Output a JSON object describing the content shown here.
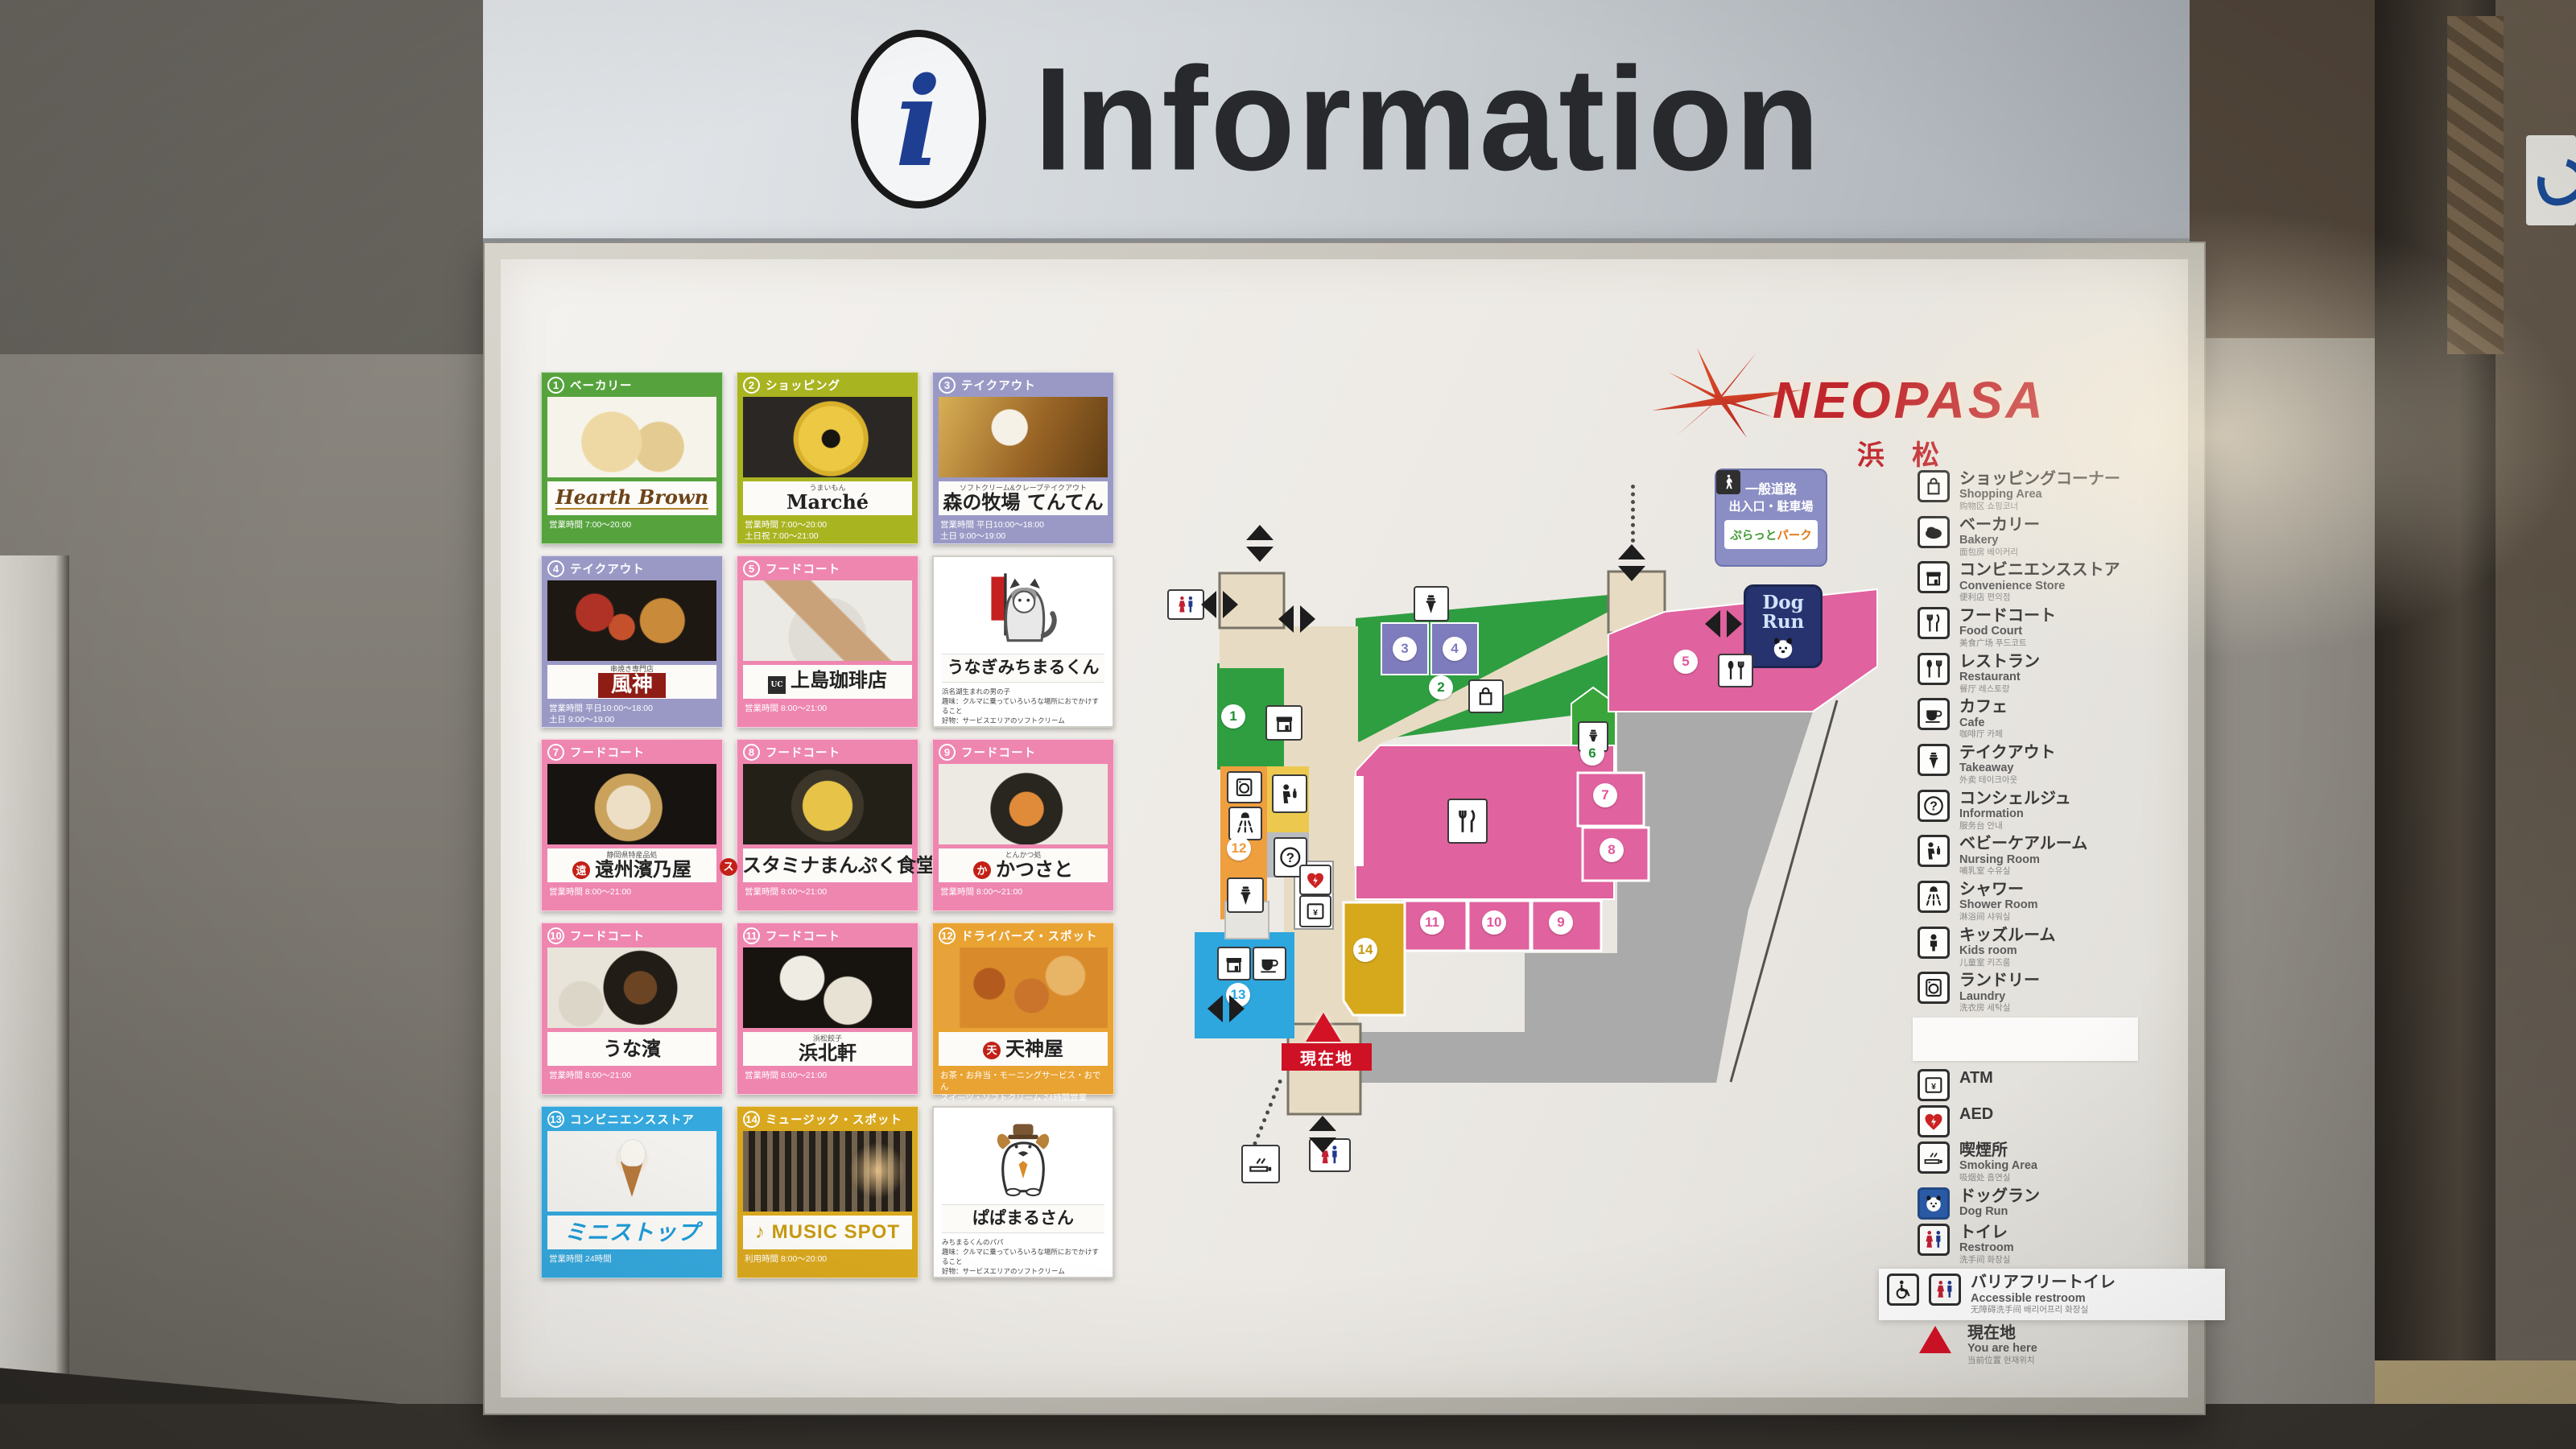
{
  "header": {
    "title": "Information",
    "icon": "info-i"
  },
  "brand": {
    "name": "NEOPASA",
    "location": "浜松"
  },
  "accent_colors": {
    "green": "#56a33e",
    "lime": "#a9b421",
    "lavender": "#9a99c6",
    "pink": "#ee86b0",
    "amber": "#e9a333",
    "blue": "#35a8dd",
    "gold": "#d9a81f",
    "map_pink": "#e0629e",
    "map_green": "#2f9e41",
    "map_beige": "#e7dcc3",
    "current_red": "#cf1126"
  },
  "cards": [
    {
      "num": "1",
      "category": "ベーカリー",
      "name": "Hearth Brown",
      "name_sub": "",
      "foot": [
        "営業時間 7:00～20:00"
      ],
      "theme": "green",
      "photo": "bread",
      "name_style": "script"
    },
    {
      "num": "2",
      "category": "ショッピング",
      "name": "Marché",
      "name_sub": "うまいもん",
      "foot": [
        "営業時間 7:00～20:00",
        "土日祝 7:00～21:00"
      ],
      "theme": "lime",
      "photo": "baum",
      "name_style": "serif"
    },
    {
      "num": "3",
      "category": "テイクアウト",
      "name": "森の牧場 てんてん",
      "name_sub": "ソフトクリーム&クレープテイクアウト",
      "foot": [
        "営業時間 平日10:00～18:00",
        "土日 9:00～19:00"
      ],
      "theme": "lav",
      "photo": "soft",
      "name_style": "plain"
    },
    {
      "num": "4",
      "category": "テイクアウト",
      "name": "風神",
      "name_sub": "串焼き専門店",
      "foot": [
        "営業時間 平日10:00～18:00",
        "土日 9:00～19:00"
      ],
      "theme": "lav",
      "photo": "skewer",
      "name_style": "banner"
    },
    {
      "num": "5",
      "category": "フードコート",
      "name": "上島珈琲店",
      "name_sub": "",
      "foot": [
        "営業時間 8:00～21:00"
      ],
      "theme": "pink",
      "photo": "sand",
      "name_style": "sqlogo"
    },
    {
      "mascot": true,
      "name": "うなぎみちまるくん",
      "profile": [
        "浜名湖生まれの男の子",
        "趣味：クルマに乗っていろいろな場所におでかけすること",
        "好物：サービスエリアのソフトクリーム"
      ],
      "photo": "mascot-unagi"
    },
    {
      "num": "7",
      "category": "フードコート",
      "name": "遠州濱乃屋",
      "name_sub": "静岡県特産品処",
      "foot": [
        "営業時間 8:00～21:00"
      ],
      "theme": "pink",
      "photo": "bowl7",
      "name_style": "dotlogo-a"
    },
    {
      "num": "8",
      "category": "フードコート",
      "name": "スタミナまんぷく食堂",
      "name_sub": "",
      "foot": [
        "営業時間 8:00～21:00"
      ],
      "theme": "pink",
      "photo": "pan8",
      "name_style": "dotlogo-b"
    },
    {
      "num": "9",
      "category": "フードコート",
      "name": "かつさと",
      "name_sub": "とんかつ処",
      "foot": [
        "営業時間 8:00～21:00"
      ],
      "theme": "pink",
      "photo": "katsu",
      "name_style": "dotlogo-c"
    },
    {
      "num": "10",
      "category": "フードコート",
      "name": "うな濱",
      "name_sub": "",
      "foot": [
        "営業時間 8:00～21:00"
      ],
      "theme": "pink",
      "photo": "unagi",
      "name_style": "serif"
    },
    {
      "num": "11",
      "category": "フードコート",
      "name": "浜北軒",
      "name_sub": "浜松餃子",
      "foot": [
        "営業時間 8:00～21:00"
      ],
      "theme": "pink",
      "photo": "gyoza",
      "name_style": "serif"
    },
    {
      "num": "12",
      "category": "ドライバーズ・スポット",
      "name": "天神屋",
      "name_sub": "",
      "foot": [
        "お茶・お弁当・モーニングサービス・おでん",
        "スイーツ・ソフトクリーム 24時間営業"
      ],
      "theme": "amber",
      "photo": "tenjin",
      "name_style": "dotlogo-d"
    },
    {
      "num": "13",
      "category": "コンビニエンスストア",
      "name": "ミニストップ",
      "name_sub": "",
      "foot": [
        "営業時間 24時間"
      ],
      "theme": "blue",
      "photo": "mini",
      "name_style": "blue-logo"
    },
    {
      "num": "14",
      "category": "ミュージック・スポット",
      "name": "MUSIC SPOT",
      "name_sub": "",
      "foot": [
        "利用時間 8:00～20:00"
      ],
      "theme": "gold",
      "photo": "music",
      "name_style": "gold-logo"
    },
    {
      "mascot": true,
      "name": "ぱぱまるさん",
      "profile": [
        "みちまるくんのパパ",
        "趣味：クルマに乗っていろいろな場所におでかけすること",
        "好物：サービスエリアのソフトクリーム"
      ],
      "photo": "mascot-papa"
    }
  ],
  "map": {
    "current_location": "現在地",
    "dog_run": {
      "line1": "Dog",
      "line2": "Run"
    },
    "platto_sign": {
      "line1": "一般道路",
      "line2": "出入口・駐車場",
      "logo_green": "ぷらっと",
      "logo_orange": "パーク"
    },
    "markers": [
      {
        "n": "1",
        "color": "green"
      },
      {
        "n": "2",
        "color": "green"
      },
      {
        "n": "3",
        "color": "purple"
      },
      {
        "n": "4",
        "color": "purple"
      },
      {
        "n": "5",
        "color": "pink"
      },
      {
        "n": "6",
        "color": "green"
      },
      {
        "n": "7",
        "color": "pink"
      },
      {
        "n": "8",
        "color": "pink"
      },
      {
        "n": "9",
        "color": "pink"
      },
      {
        "n": "10",
        "color": "pink"
      },
      {
        "n": "11",
        "color": "pink"
      },
      {
        "n": "12",
        "color": "orange"
      },
      {
        "n": "13",
        "color": "blue"
      },
      {
        "n": "14",
        "color": "mustard"
      }
    ]
  },
  "legend": [
    {
      "icon": "bag",
      "jp": "ショッピングコーナー",
      "en": "Shopping Area",
      "sub": "购物区 쇼핑코너"
    },
    {
      "icon": "bread",
      "jp": "ベーカリー",
      "en": "Bakery",
      "sub": "面包房 베이커리"
    },
    {
      "icon": "store",
      "jp": "コンビニエンスストア",
      "en": "Convenience Store",
      "sub": "便利店 편의점"
    },
    {
      "icon": "forkknife",
      "jp": "フードコート",
      "en": "Food Court",
      "sub": "美食广场 푸드코트"
    },
    {
      "icon": "spoonfork",
      "jp": "レストラン",
      "en": "Restaurant",
      "sub": "餐厅 레스토랑"
    },
    {
      "icon": "cup",
      "jp": "カフェ",
      "en": "Cafe",
      "sub": "咖啡厅 카페"
    },
    {
      "icon": "softcream",
      "jp": "テイクアウト",
      "en": "Takeaway",
      "sub": "外卖 테이크아웃"
    },
    {
      "icon": "question",
      "jp": "コンシェルジュ",
      "en": "Information",
      "sub": "服务台 안내"
    },
    {
      "icon": "nursing",
      "jp": "ベビーケアルーム",
      "en": "Nursing Room",
      "sub": "哺乳室 수유실"
    },
    {
      "icon": "shower",
      "jp": "シャワー",
      "en": "Shower Room",
      "sub": "淋浴间 샤워실"
    },
    {
      "icon": "kids",
      "jp": "キッズルーム",
      "en": "Kids room",
      "sub": "儿童室 키즈룸"
    },
    {
      "icon": "laundry",
      "jp": "ランドリー",
      "en": "Laundry",
      "sub": "洗衣房 세탁실"
    },
    {
      "icon": "blank",
      "jp": "",
      "en": "",
      "sub": "",
      "blank": true
    },
    {
      "icon": "atm",
      "jp": "ATM",
      "en": "",
      "sub": ""
    },
    {
      "icon": "aed",
      "jp": "AED",
      "en": "",
      "sub": ""
    },
    {
      "icon": "smoking",
      "jp": "喫煙所",
      "en": "Smoking Area",
      "sub": "吸烟处 흡연실"
    },
    {
      "icon": "dog",
      "jp": "ドッグラン",
      "en": "Dog Run",
      "sub": ""
    },
    {
      "icon": "restroom",
      "jp": "トイレ",
      "en": "Restroom",
      "sub": "洗手间 화장실"
    },
    {
      "icon": "wheelchair",
      "jp": "バリアフリートイレ",
      "en": "Accessible restroom",
      "sub": "无障碍洗手间 배리어프리 화장실",
      "highlight": true
    },
    {
      "icon": "triangle",
      "jp": "現在地",
      "en": "You are here",
      "sub": "当前位置 현재위치"
    }
  ]
}
